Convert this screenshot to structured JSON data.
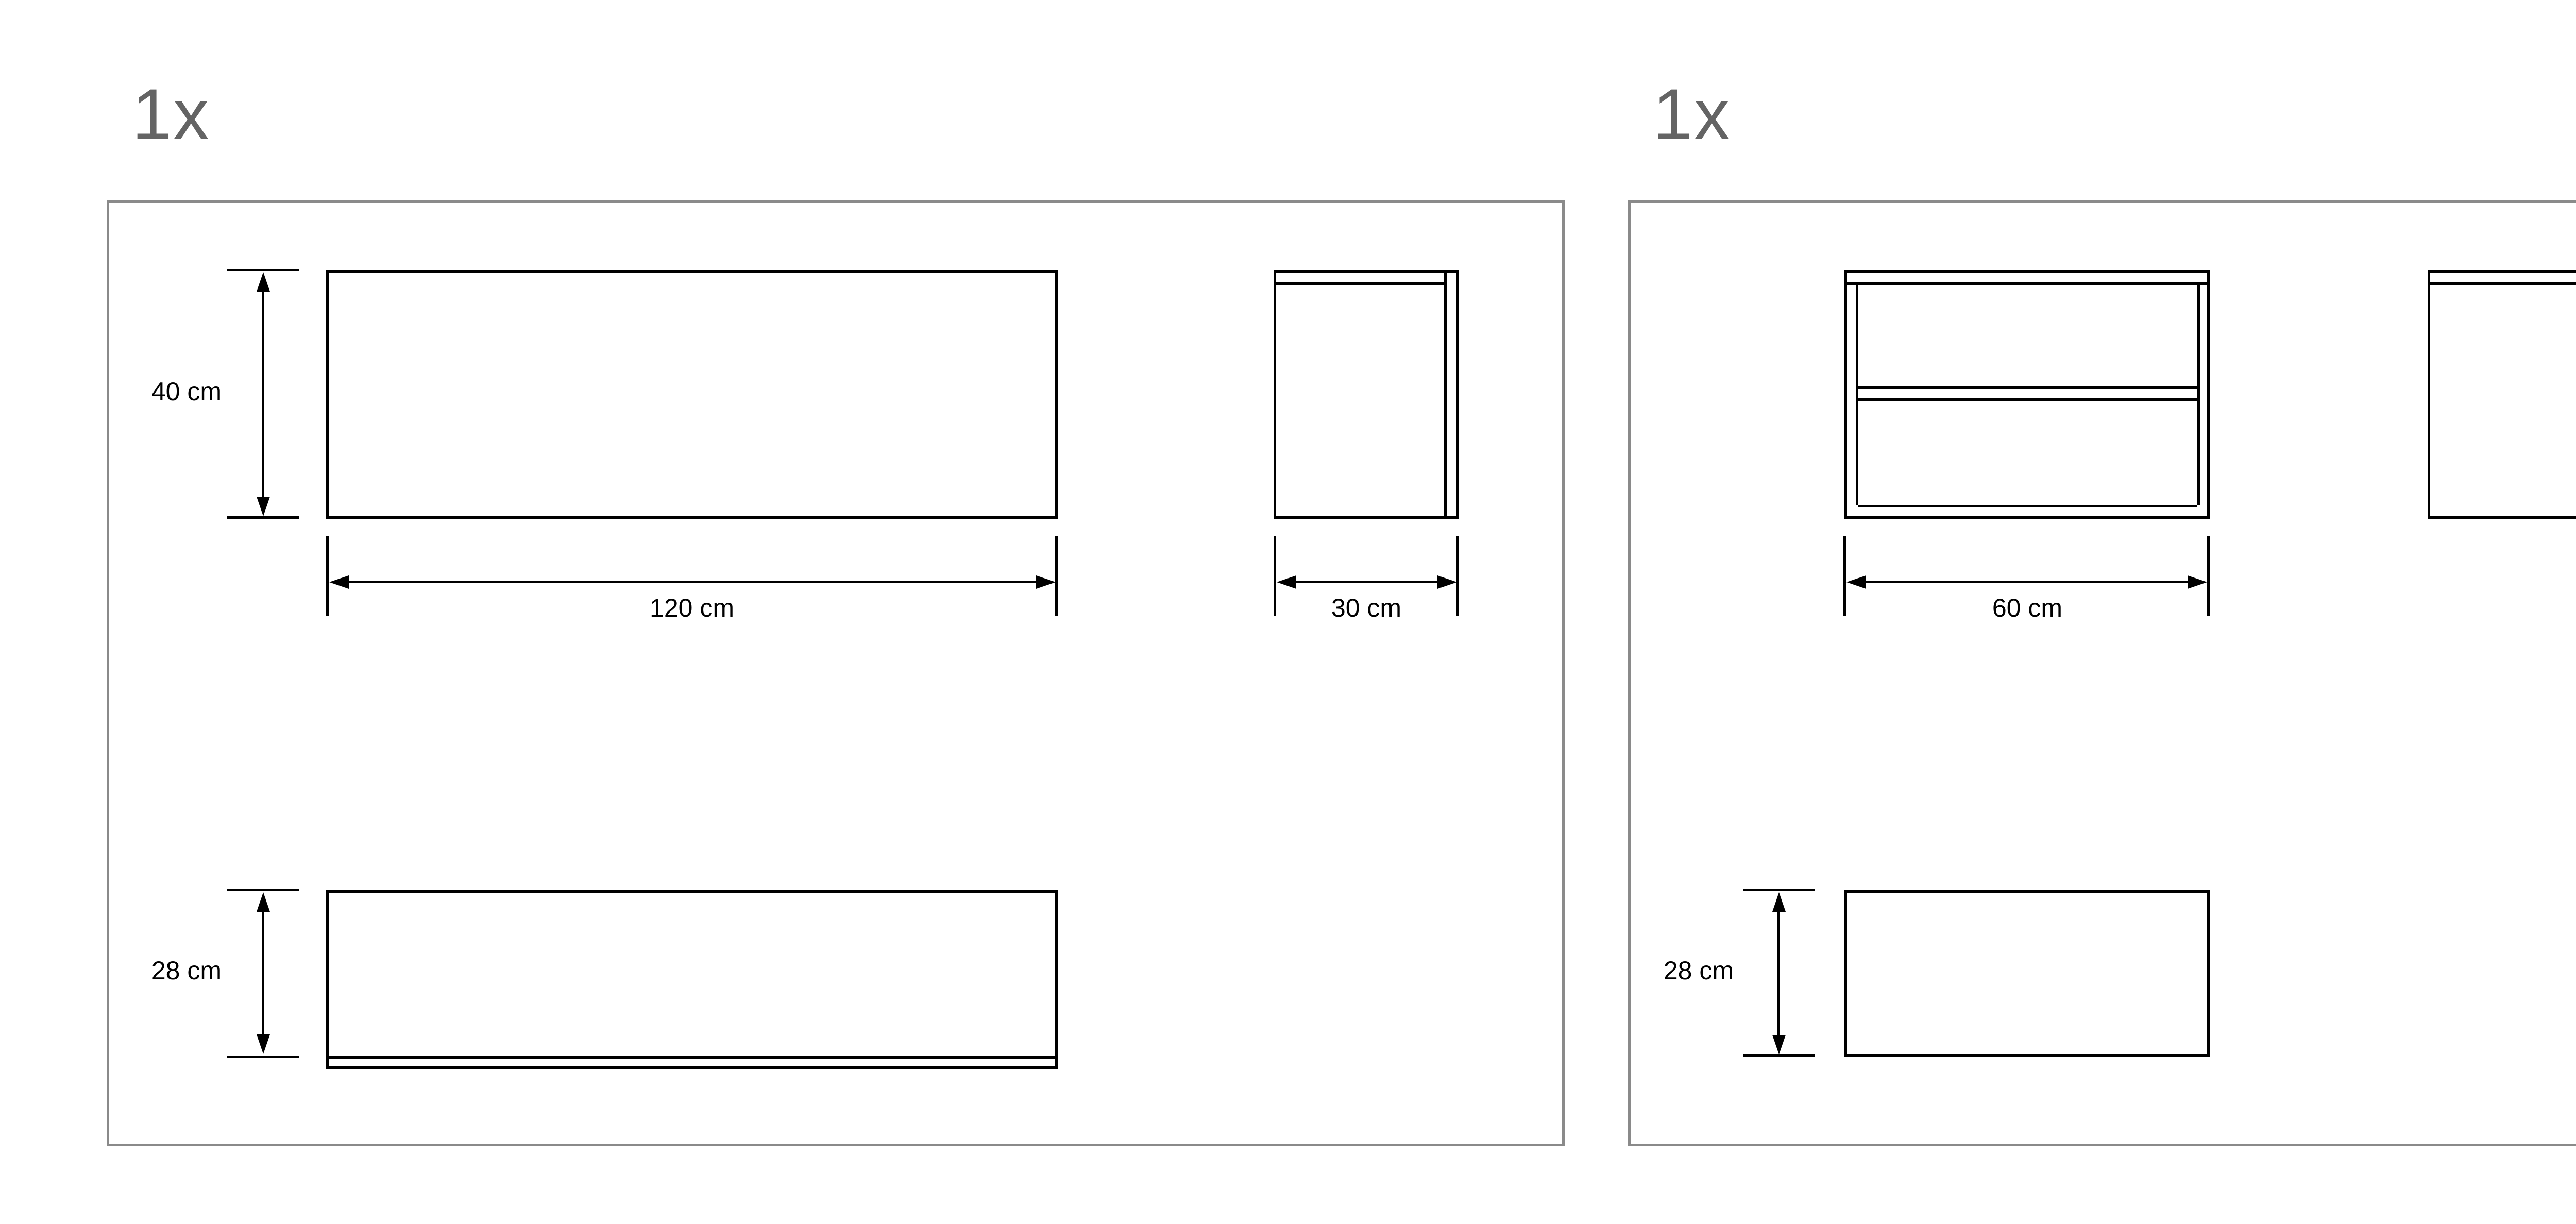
{
  "colors": {
    "background": "#ffffff",
    "drawing_line": "#000000",
    "panel_border": "#8a8a8a",
    "quantity_text": "#646464",
    "dimension_text": "#000000"
  },
  "panels": [
    {
      "quantity_label": "1x",
      "views": {
        "front": {
          "height": "40 cm",
          "width": "120 cm"
        },
        "side": {
          "width": "30 cm"
        },
        "bottom_board": {
          "height": "28 cm"
        }
      }
    },
    {
      "quantity_label": "1x",
      "views": {
        "front": {
          "width": "60 cm"
        },
        "side": {
          "height": "40 cm"
        },
        "bottom_board": {
          "height": "28 cm"
        }
      }
    }
  ]
}
